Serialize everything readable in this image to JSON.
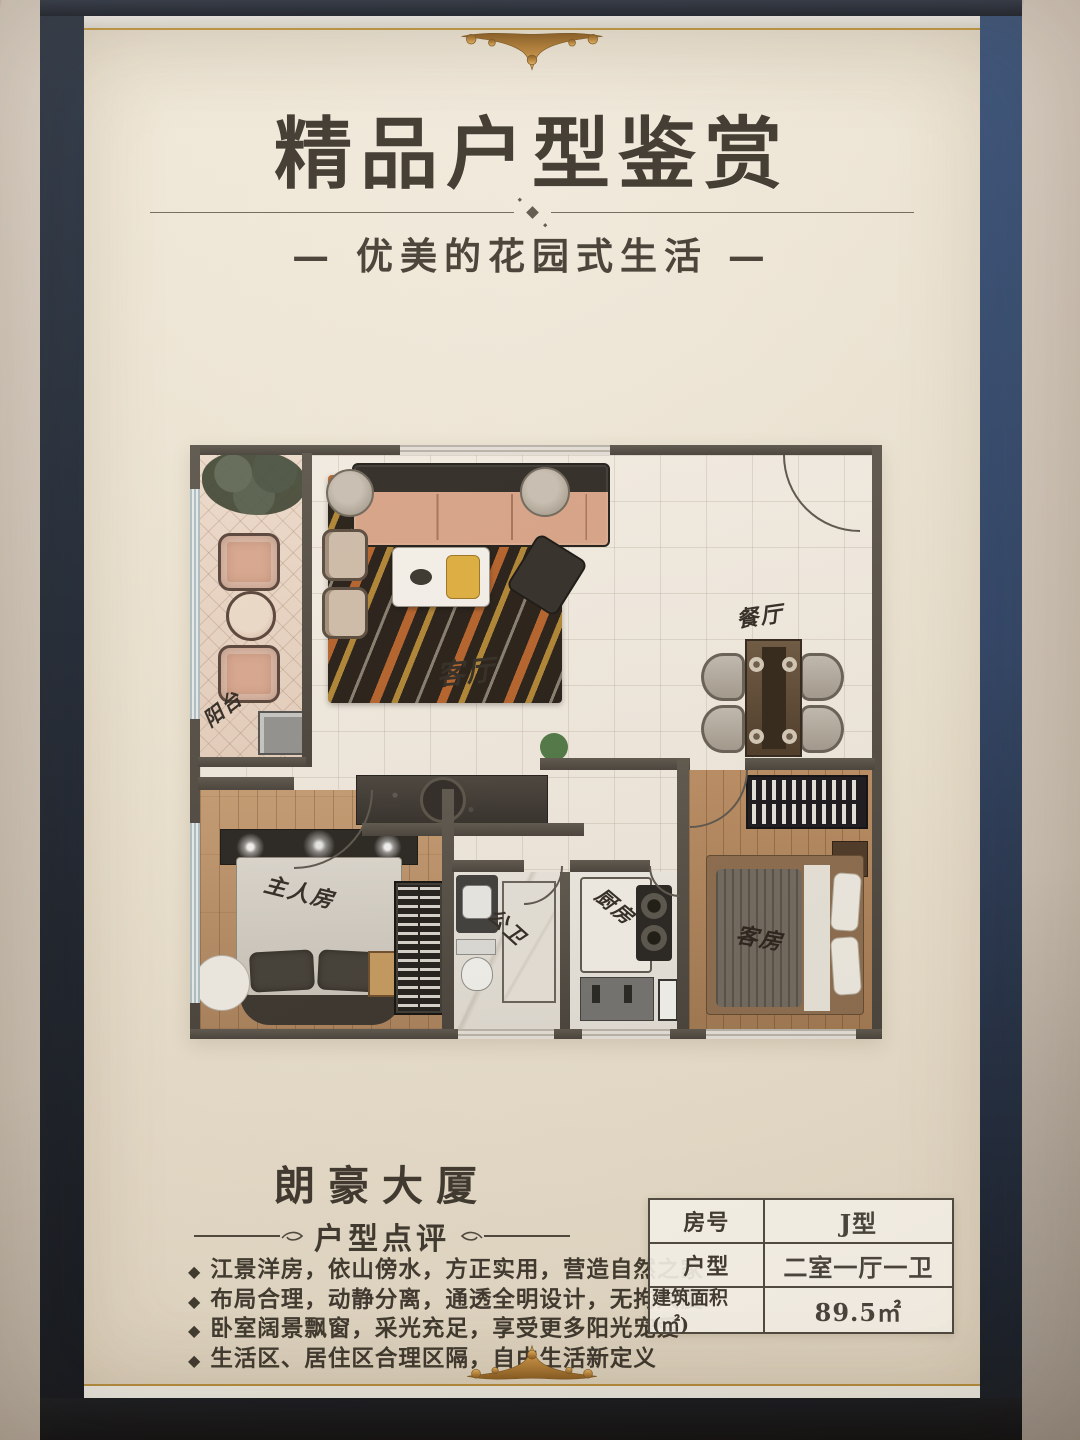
{
  "poster": {
    "title": "精品户型鉴赏",
    "subtitle": "— 优美的花园式生活 —"
  },
  "floorplan": {
    "rooms": {
      "balcony": "阳台",
      "living": "客厅",
      "dining": "餐厅",
      "master": "主人房",
      "bathroom": "公卫",
      "kitchen": "厨房",
      "guest": "客房"
    }
  },
  "review": {
    "building_name": "朗豪大厦",
    "section_title": "户型点评",
    "bullet_icon": "◆",
    "bullets": [
      "江景洋房，依山傍水，方正实用，营造自然之家",
      "布局合理，动静分离，通透全明设计，无拘尺度",
      "卧室阔景飘窗，采光充足，享受更多阳光宠爱",
      "生活区、居住区合理区隔，自由生活新定义"
    ]
  },
  "spec_table": {
    "rows": [
      {
        "label": "房号",
        "value": "J型"
      },
      {
        "label": "户型",
        "value": "二室一厅一卫"
      },
      {
        "label": "建筑面积(㎡)",
        "value": "89.5㎡"
      }
    ]
  },
  "colors": {
    "frame_navy": "#2b4166",
    "frame_dark": "#161d2a",
    "poster_cream": "#ede5d4",
    "marble": "#d6ccc0",
    "gold": "#c89245",
    "ink": "#3a342b",
    "wall_gray": "#4e4a45",
    "wood": "#b58a62",
    "tile": "#f3ede4"
  }
}
